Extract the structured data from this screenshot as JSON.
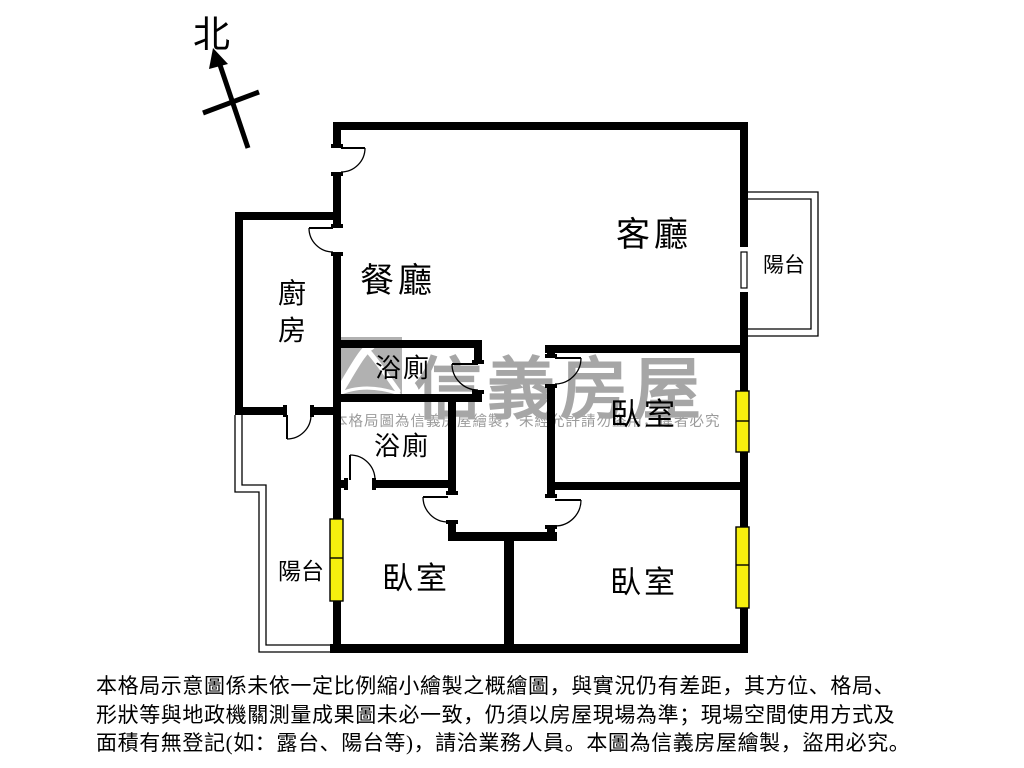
{
  "north_label": "北",
  "rooms": {
    "living": "客廳",
    "dining": "餐廳",
    "kitchen": "廚房",
    "balcony_right": "陽台",
    "balcony_left": "陽台",
    "bath_upper": "浴廁",
    "bath_lower": "浴廁",
    "bedroom_right": "臥室",
    "bedroom_bottom_left": "臥室",
    "bedroom_bottom_right": "臥室"
  },
  "watermark": {
    "brand": "信義房屋",
    "notice": "本格局圖為信義房屋繪製，未經允許請勿盜用，違者必究"
  },
  "disclaimer": {
    "lines": [
      "本格局示意圖係未依一定比例縮小繪製之概繪圖，與實況仍有差距，其方位、格局、",
      "形狀等與地政機關測量成果圖未必一致，仍須以房屋現場為準；現場空間使用方式及",
      "面積有無登記(如：露台、陽台等)，請洽業務人員。本圖為信義房屋繪製，盜用必究。"
    ]
  },
  "colors": {
    "wall": "#000000",
    "window": "#f6ef0e",
    "watermark_grey": "#a6a6a6",
    "logo_grey": "#b1b1b1"
  }
}
